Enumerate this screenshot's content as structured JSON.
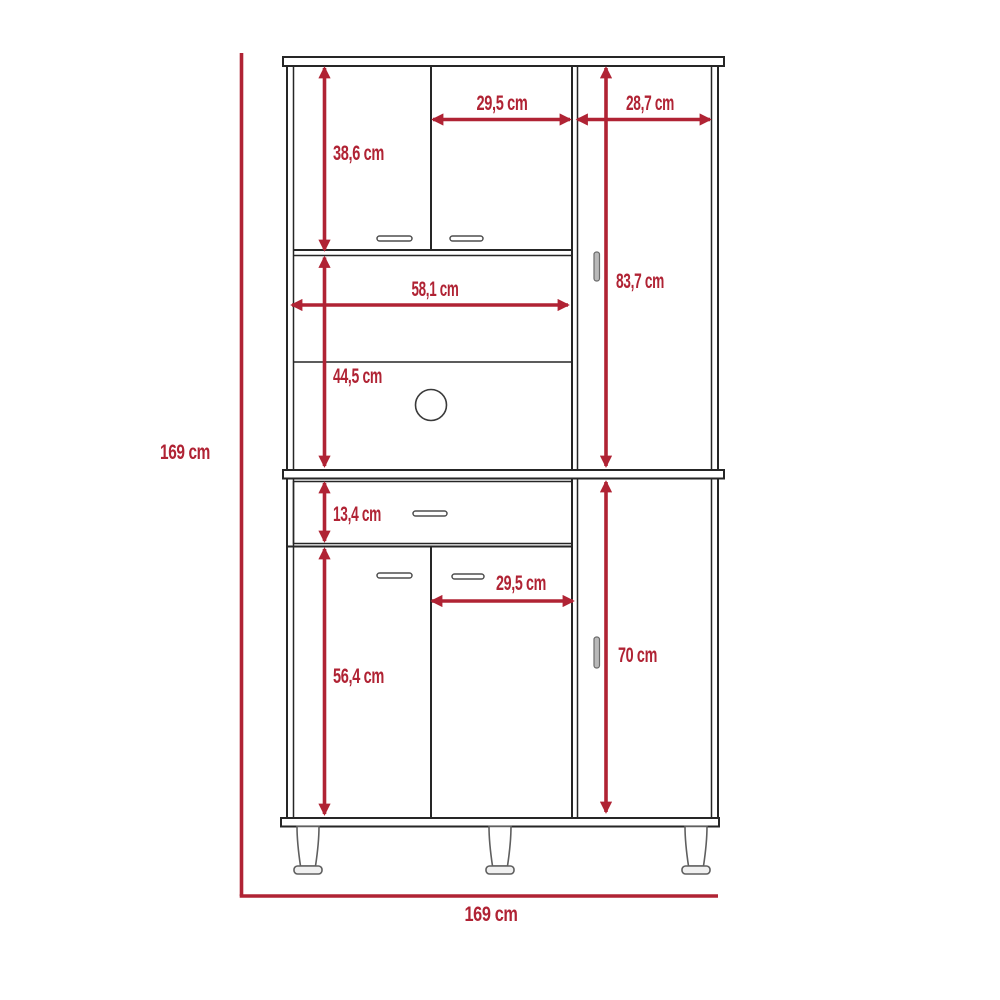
{
  "diagram": {
    "type": "furniture-dimension-diagram",
    "subject": "pantry cabinet front elevation with dimension callouts",
    "unit": "cm",
    "overall": {
      "height": {
        "label": "169 cm",
        "value": 169
      },
      "width": {
        "label": "169 cm",
        "value": 169
      }
    },
    "dimensions": {
      "upper_left_door_height": {
        "label": "38,6 cm",
        "value": 38.6,
        "orientation": "vertical"
      },
      "upper_middle_door_width": {
        "label": "29,5 cm",
        "value": 29.5,
        "orientation": "horizontal"
      },
      "upper_right_section_width": {
        "label": "28,7 cm",
        "value": 28.7,
        "orientation": "horizontal"
      },
      "upper_right_door_height": {
        "label": "83,7 cm",
        "value": 83.7,
        "orientation": "vertical"
      },
      "open_compartment_width": {
        "label": "58,1 cm",
        "value": 58.1,
        "orientation": "horizontal"
      },
      "open_compartment_height": {
        "label": "44,5 cm",
        "value": 44.5,
        "orientation": "vertical"
      },
      "drawer_height": {
        "label": "13,4 cm",
        "value": 13.4,
        "orientation": "vertical"
      },
      "lower_middle_door_width": {
        "label": "29,5 cm",
        "value": 29.5,
        "orientation": "horizontal"
      },
      "lower_left_door_height": {
        "label": "56,4 cm",
        "value": 56.4,
        "orientation": "vertical"
      },
      "lower_right_door_height": {
        "label": "70 cm",
        "value": 70,
        "orientation": "vertical"
      }
    },
    "colors": {
      "dimension": "#B02334",
      "structure": "#262626",
      "hardware": "#b9b9b9",
      "background": "#ffffff"
    }
  }
}
